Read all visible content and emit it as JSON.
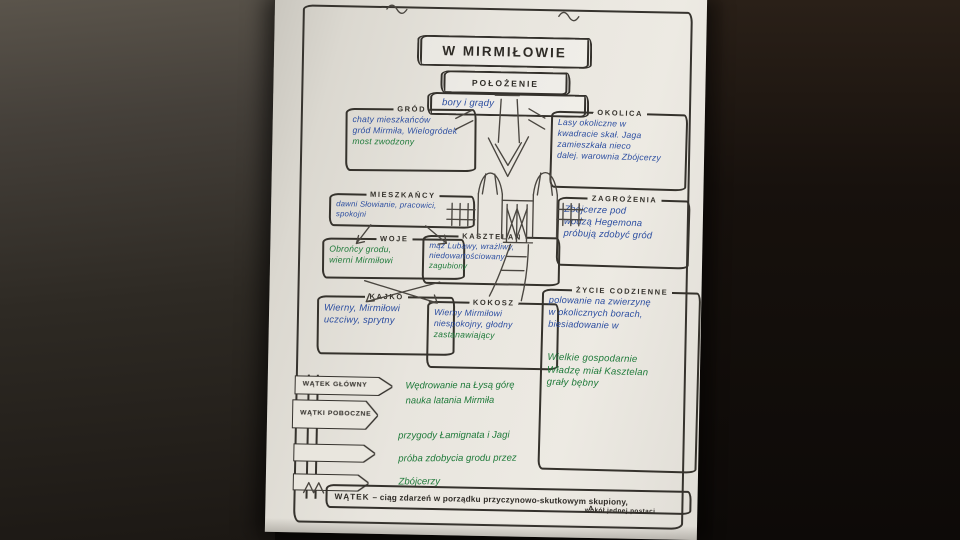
{
  "photo": {
    "surround_left": "#45403a",
    "surround_right": "#17110d",
    "paper": "#e8e5de"
  },
  "ink": {
    "blue": "#2b4da0",
    "green": "#1f7a3a",
    "black": "#2f2c27"
  },
  "paper": {
    "title": "W MIRMIŁOWIE",
    "location_label": "POŁOŻENIE",
    "location_note": "bory i grądy",
    "boxes": {
      "grod": {
        "title": "GRÓD",
        "lines": [
          {
            "text": "chaty mieszkańców",
            "ink": "blue"
          },
          {
            "text": "gród Mirmiła, Wielogródek",
            "ink": "blue"
          },
          {
            "text": "most zwodzony",
            "ink": "green"
          }
        ]
      },
      "okolica": {
        "title": "OKOLICA",
        "lines": [
          {
            "text": "Lasy okoliczne w",
            "ink": "blue"
          },
          {
            "text": "kwadracie skał. Jaga",
            "ink": "blue"
          },
          {
            "text": "zamieszkała nieco",
            "ink": "blue"
          },
          {
            "text": "dalej. warownia Zbójcerzy",
            "ink": "blue"
          }
        ]
      },
      "mieszkancy": {
        "title": "MIESZKAŃCY",
        "lines": [
          {
            "text": "dawni Słowianie, pracowici,",
            "ink": "blue"
          },
          {
            "text": "spokojni",
            "ink": "blue"
          }
        ]
      },
      "zagrozenia": {
        "title": "ZAGROŻENIA",
        "lines": [
          {
            "text": "Zbójcerze pod",
            "ink": "blue"
          },
          {
            "text": "wodzą Hegemona",
            "ink": "blue"
          },
          {
            "text": "próbują zdobyć gród",
            "ink": "blue"
          }
        ]
      },
      "woje": {
        "title": "WOJE",
        "lines": [
          {
            "text": "Obrońcy grodu,",
            "ink": "green"
          },
          {
            "text": "wierni Mirmiłowi",
            "ink": "green"
          }
        ]
      },
      "kasztelan": {
        "title": "KASZTELAN",
        "lines": [
          {
            "text": "mąż Lubawy, wrażliwy,",
            "ink": "blue"
          },
          {
            "text": "niedowartościowany,",
            "ink": "blue"
          },
          {
            "text": "zagubiony",
            "ink": "green"
          }
        ]
      },
      "kajko": {
        "title": "KAJKO",
        "lines": [
          {
            "text": "Wierny, Mirmiłowi",
            "ink": "blue"
          },
          {
            "text": "uczciwy, sprytny",
            "ink": "blue"
          }
        ]
      },
      "kokosz": {
        "title": "KOKOSZ",
        "lines": [
          {
            "text": "Wierny Mirmiłowi",
            "ink": "blue"
          },
          {
            "text": "niespokojny, głodny",
            "ink": "blue"
          },
          {
            "text": "zastanawiający",
            "ink": "green"
          }
        ]
      },
      "zycie": {
        "title": "ŻYCIE CODZIENNE",
        "lines": [
          {
            "text": "polowanie na zwierzynę",
            "ink": "blue"
          },
          {
            "text": "w okolicznych borach,",
            "ink": "blue"
          },
          {
            "text": "biesiadowanie w",
            "ink": "blue"
          },
          {
            "text": "Wielkie gospodarnie",
            "ink": "green"
          },
          {
            "text": "Władzę miał Kasztelan",
            "ink": "green"
          },
          {
            "text": "grały bębny",
            "ink": "green"
          }
        ]
      }
    },
    "signpost": {
      "signs": [
        {
          "label": "WĄTEK GŁÓWNY"
        },
        {
          "label": "WĄTKI POBOCZNE"
        },
        {
          "label": ""
        },
        {
          "label": ""
        }
      ]
    },
    "plot_notes": {
      "main": [
        "Wędrowanie na Łysą górę",
        "nauka latania Mirmiła"
      ],
      "side": [
        "przygody Łamignata i Jagi",
        "próba zdobycia grodu przez",
        "Zbójcerzy"
      ]
    },
    "footer": {
      "term": "WĄTEK",
      "definition": "– ciąg zdarzeń w porządku przyczynowo-skutkowym skupiony,",
      "caret": "ʌ",
      "addendum": "wokół jednej postaci"
    }
  }
}
